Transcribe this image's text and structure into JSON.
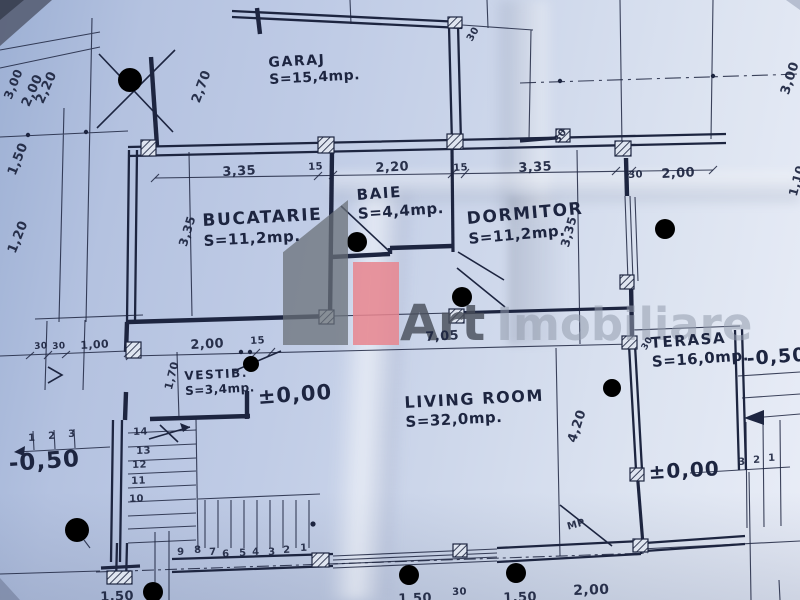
{
  "colors": {
    "ink": "#1d2540",
    "paper": "#c3cee8",
    "accent": "#e8858e",
    "logo-gray": "#6a7078"
  },
  "watermark": {
    "brand_bold": "Art",
    "brand_light": "Imobiliare"
  },
  "rooms": [
    {
      "id": "garaj",
      "name": "GARAJ",
      "area": "S=15,4mp.",
      "x": 268,
      "y": 55,
      "r": -3,
      "name_size": 14,
      "area_size": 14
    },
    {
      "id": "bucatarie",
      "name": "BUCATARIE",
      "area": "S=11,2mp.",
      "x": 202,
      "y": 211,
      "r": -3,
      "name_size": 17,
      "area_size": 15
    },
    {
      "id": "baie",
      "name": "BAIE",
      "area": "S=4,4mp.",
      "x": 356,
      "y": 186,
      "r": -4,
      "name_size": 15,
      "area_size": 15
    },
    {
      "id": "dormitor",
      "name": "DORMITOR",
      "area": "S=11,2mp.",
      "x": 466,
      "y": 209,
      "r": -5,
      "name_size": 17,
      "area_size": 15
    },
    {
      "id": "terasa",
      "name": "TERASA",
      "area": "S=16,0mp.",
      "x": 650,
      "y": 334,
      "r": -4,
      "name_size": 15,
      "area_size": 15
    },
    {
      "id": "vestibul",
      "name": "VESTIB.",
      "area": "S=3,4mp.",
      "x": 184,
      "y": 369,
      "r": -3,
      "name_size": 12,
      "area_size": 12
    },
    {
      "id": "living",
      "name": "LIVING ROOM",
      "area": "S=32,0mp.",
      "x": 404,
      "y": 393,
      "r": -3,
      "name_size": 16,
      "area_size": 15
    }
  ],
  "level_labels": [
    {
      "t": "±0,00",
      "x": 257,
      "y": 385,
      "s": 21,
      "r": -4
    },
    {
      "t": "±0,00",
      "x": 648,
      "y": 460,
      "s": 20,
      "r": -3
    },
    {
      "t": "-0,50",
      "x": 8,
      "y": 451,
      "s": 23,
      "r": -4
    },
    {
      "t": "-0,50",
      "x": 746,
      "y": 348,
      "s": 19,
      "r": -4
    }
  ],
  "dim_labels": [
    {
      "t": "3,35",
      "x": 222,
      "y": 165,
      "s": 13,
      "r": -3
    },
    {
      "t": "15",
      "x": 308,
      "y": 162,
      "s": 10,
      "r": -3
    },
    {
      "t": "2,20",
      "x": 375,
      "y": 161,
      "s": 13,
      "r": -3
    },
    {
      "t": "15",
      "x": 453,
      "y": 163,
      "s": 10,
      "r": -3
    },
    {
      "t": "3,35",
      "x": 518,
      "y": 161,
      "s": 13,
      "r": -3
    },
    {
      "t": "30",
      "x": 628,
      "y": 170,
      "s": 10,
      "r": -3
    },
    {
      "t": "2,00",
      "x": 661,
      "y": 167,
      "s": 13,
      "r": -3
    },
    {
      "t": "2,00",
      "x": 190,
      "y": 338,
      "s": 13,
      "r": -3
    },
    {
      "t": "15",
      "x": 250,
      "y": 336,
      "s": 10,
      "r": -3
    },
    {
      "t": "7,05",
      "x": 425,
      "y": 330,
      "s": 13,
      "r": -3
    },
    {
      "t": "3,35",
      "x": 176,
      "y": 244,
      "s": 12,
      "r": -73
    },
    {
      "t": "3,35",
      "x": 558,
      "y": 245,
      "s": 12,
      "r": -75
    },
    {
      "t": "4,20",
      "x": 565,
      "y": 440,
      "s": 13,
      "r": -72
    },
    {
      "t": "1,70",
      "x": 162,
      "y": 388,
      "s": 11,
      "r": -76
    },
    {
      "t": "2,70",
      "x": 189,
      "y": 100,
      "s": 13,
      "r": -70
    },
    {
      "t": "30",
      "x": 465,
      "y": 38,
      "s": 10,
      "r": -60
    },
    {
      "t": "3,00",
      "x": 778,
      "y": 92,
      "s": 13,
      "r": -72
    },
    {
      "t": "30",
      "x": 552,
      "y": 139,
      "s": 10,
      "r": -55
    },
    {
      "t": "1,10",
      "x": 786,
      "y": 194,
      "s": 12,
      "r": -75
    },
    {
      "t": "3,00",
      "x": 1,
      "y": 96,
      "s": 12,
      "r": -68
    },
    {
      "t": "2,00",
      "x": 19,
      "y": 103,
      "s": 13,
      "r": -66
    },
    {
      "t": "2,20",
      "x": 33,
      "y": 100,
      "s": 13,
      "r": -66
    },
    {
      "t": "1,50",
      "x": 5,
      "y": 172,
      "s": 13,
      "r": -68
    },
    {
      "t": "1,20",
      "x": 5,
      "y": 250,
      "s": 13,
      "r": -68
    },
    {
      "t": "30",
      "x": 34,
      "y": 342,
      "s": 9,
      "r": -3
    },
    {
      "t": "30",
      "x": 52,
      "y": 342,
      "s": 9,
      "r": -3
    },
    {
      "t": "1,00",
      "x": 80,
      "y": 339,
      "s": 11,
      "r": -3
    },
    {
      "t": "30",
      "x": 640,
      "y": 347,
      "s": 9,
      "r": -60
    },
    {
      "t": "1,50",
      "x": 100,
      "y": 590,
      "s": 13,
      "r": -2
    },
    {
      "t": "1,50",
      "x": 398,
      "y": 592,
      "s": 13,
      "r": -2
    },
    {
      "t": "30",
      "x": 452,
      "y": 587,
      "s": 10,
      "r": -2
    },
    {
      "t": "1,50",
      "x": 503,
      "y": 591,
      "s": 13,
      "r": -2
    },
    {
      "t": "2,00",
      "x": 573,
      "y": 583,
      "s": 14,
      "r": -2
    },
    {
      "t": "MP",
      "x": 566,
      "y": 522,
      "s": 10,
      "r": -15
    }
  ],
  "stair_numbers": [
    {
      "t": "14",
      "x": 133,
      "y": 427
    },
    {
      "t": "13",
      "x": 136,
      "y": 446
    },
    {
      "t": "12",
      "x": 132,
      "y": 460
    },
    {
      "t": "11",
      "x": 131,
      "y": 476
    },
    {
      "t": "10",
      "x": 129,
      "y": 494
    },
    {
      "t": "9",
      "x": 177,
      "y": 547
    },
    {
      "t": "8",
      "x": 194,
      "y": 545
    },
    {
      "t": "7",
      "x": 209,
      "y": 547
    },
    {
      "t": "6",
      "x": 222,
      "y": 549
    },
    {
      "t": "5",
      "x": 239,
      "y": 548
    },
    {
      "t": "4",
      "x": 252,
      "y": 547
    },
    {
      "t": "3",
      "x": 268,
      "y": 547
    },
    {
      "t": "2",
      "x": 283,
      "y": 545
    },
    {
      "t": "1",
      "x": 300,
      "y": 543
    },
    {
      "t": "1",
      "x": 28,
      "y": 433
    },
    {
      "t": "2",
      "x": 48,
      "y": 431
    },
    {
      "t": "3",
      "x": 68,
      "y": 429
    },
    {
      "t": "3",
      "x": 738,
      "y": 457
    },
    {
      "t": "2",
      "x": 753,
      "y": 455
    },
    {
      "t": "1",
      "x": 768,
      "y": 453
    }
  ]
}
